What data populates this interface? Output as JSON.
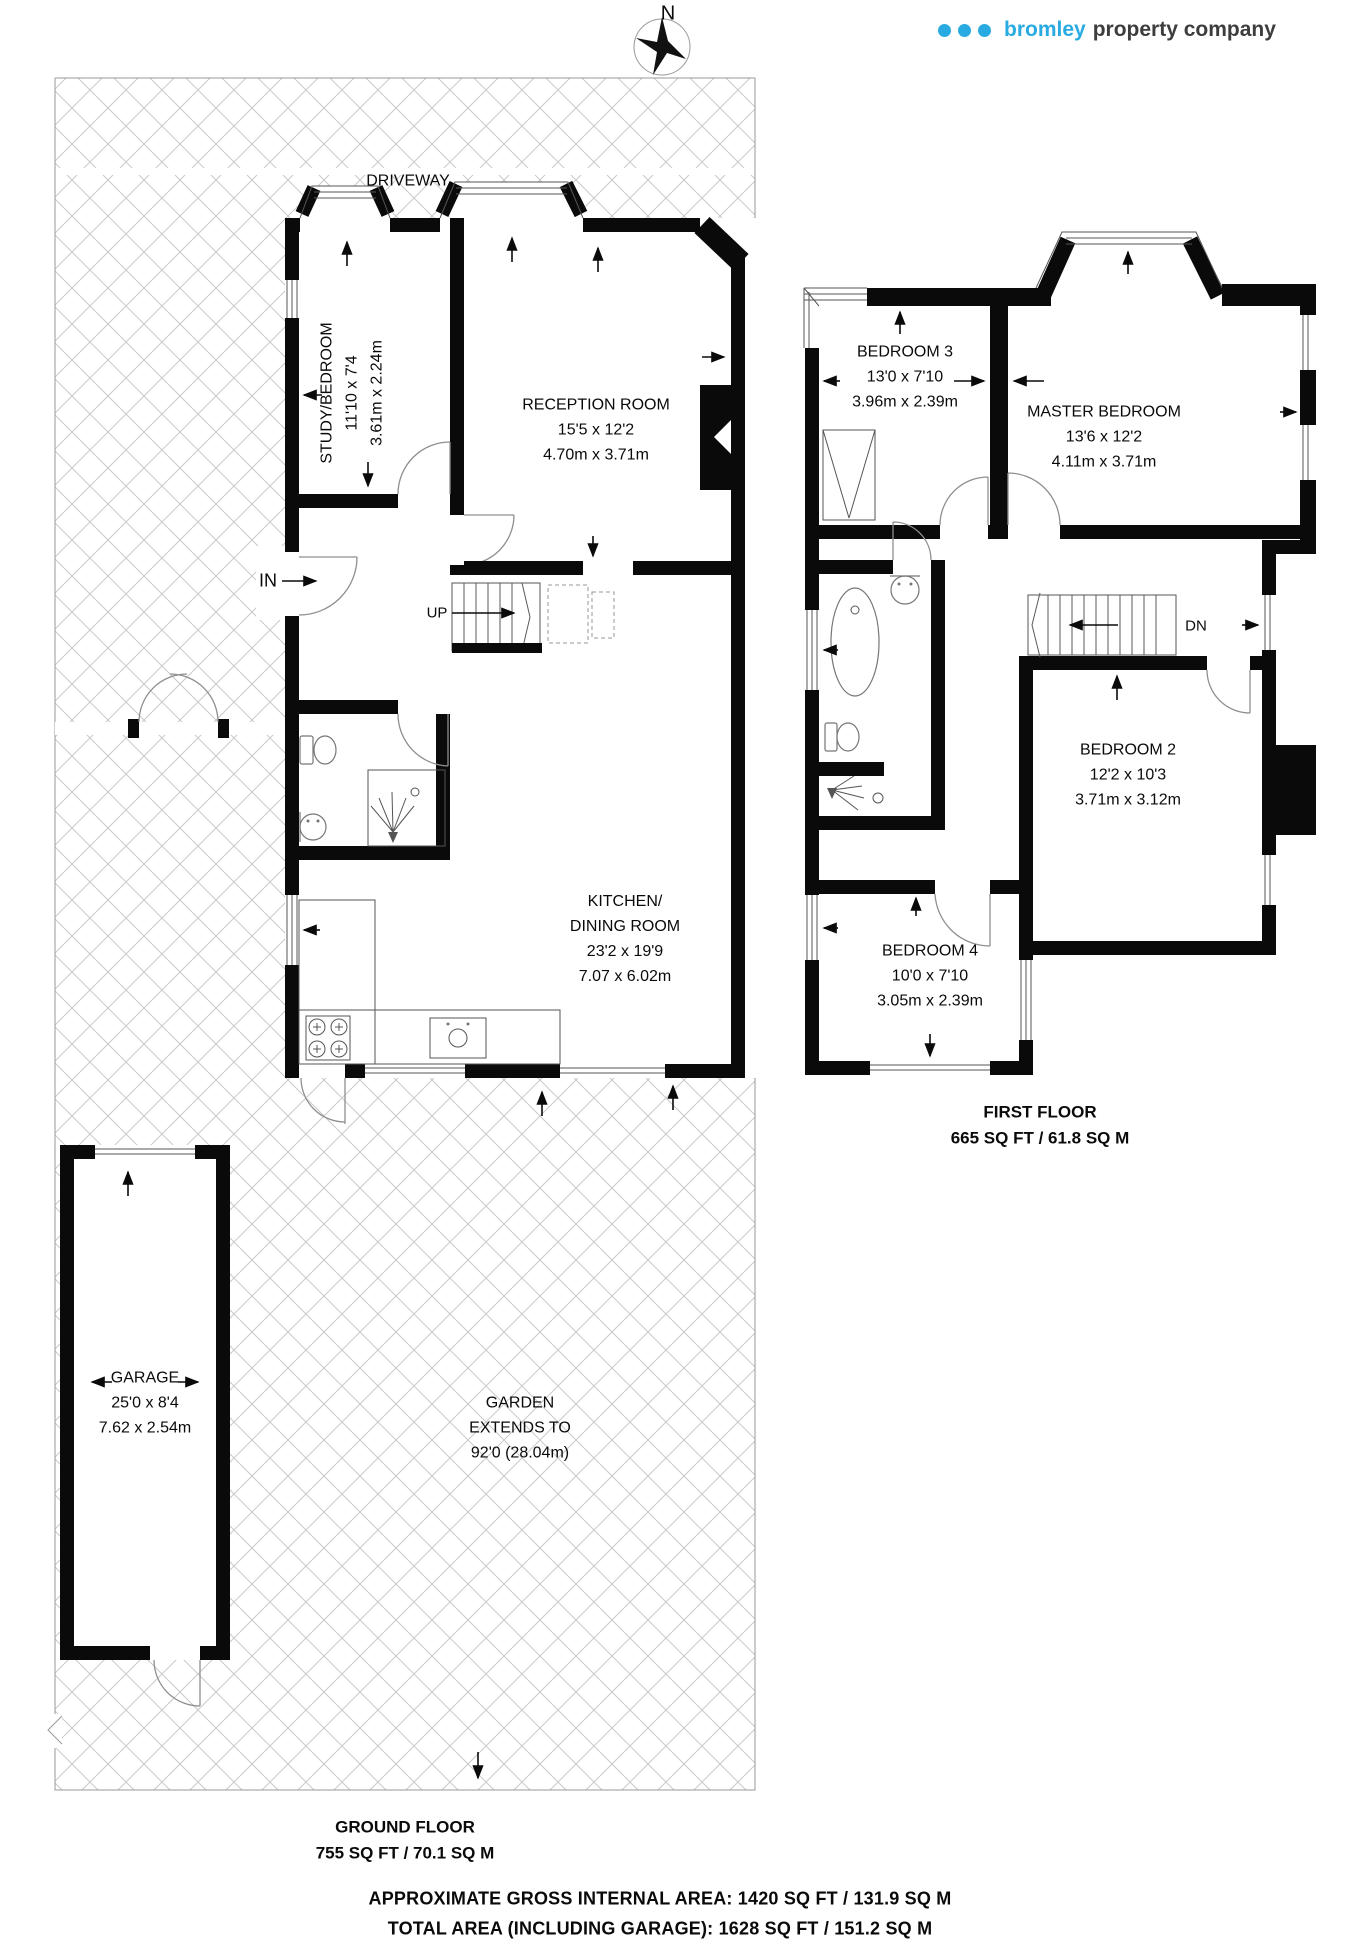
{
  "header": {
    "compass_label": "N",
    "logo": {
      "name": "bromley",
      "suffix": "property company",
      "accent_color": "#29abe2",
      "text_color": "#3d3d3d"
    }
  },
  "outdoor": {
    "driveway_label": "DRIVEWAY",
    "garden_line1": "GARDEN",
    "garden_line2": "EXTENDS TO",
    "garden_line3": "92'0 (28.04m)"
  },
  "ground_floor": {
    "title": "GROUND FLOOR",
    "area": "755 SQ FT / 70.1 SQ M",
    "entrance_label": "IN",
    "stairs_up_label": "UP"
  },
  "first_floor": {
    "title": "FIRST FLOOR",
    "area": "665 SQ FT / 61.8 SQ M",
    "stairs_down_label": "DN"
  },
  "rooms": [
    {
      "id": "study-bedroom",
      "name": "STUDY/BEDROOM",
      "dim_ft": "11'10 x 7'4",
      "dim_m": "3.61m x 2.24m",
      "x": 352,
      "y": 393,
      "rotated": true
    },
    {
      "id": "reception-room",
      "name": "RECEPTION ROOM",
      "dim_ft": "15'5 x 12'2",
      "dim_m": "4.70m x 3.71m",
      "x": 596,
      "y": 430,
      "rotated": false
    },
    {
      "id": "kitchen-dining-room",
      "name": "KITCHEN/",
      "name2": "DINING ROOM",
      "dim_ft": "23'2 x 19'9",
      "dim_m": "7.07 x 6.02m",
      "x": 625,
      "y": 939,
      "rotated": false
    },
    {
      "id": "garage",
      "name": "GARAGE",
      "dim_ft": "25'0 x 8'4",
      "dim_m": "7.62 x 2.54m",
      "x": 145,
      "y": 1403,
      "rotated": false
    },
    {
      "id": "bedroom-3",
      "name": "BEDROOM 3",
      "dim_ft": "13'0 x 7'10",
      "dim_m": "3.96m x 2.39m",
      "x": 905,
      "y": 377,
      "rotated": false
    },
    {
      "id": "master-bedroom",
      "name": "MASTER BEDROOM",
      "dim_ft": "13'6 x 12'2",
      "dim_m": "4.11m x 3.71m",
      "x": 1104,
      "y": 437,
      "rotated": false
    },
    {
      "id": "bedroom-2",
      "name": "BEDROOM 2",
      "dim_ft": "12'2 x 10'3",
      "dim_m": "3.71m x 3.12m",
      "x": 1128,
      "y": 775,
      "rotated": false
    },
    {
      "id": "bedroom-4",
      "name": "BEDROOM 4",
      "dim_ft": "10'0 x 7'10",
      "dim_m": "3.05m x 2.39m",
      "x": 930,
      "y": 976,
      "rotated": false
    }
  ],
  "summary": {
    "line1": "APPROXIMATE GROSS INTERNAL AREA: 1420 SQ FT / 131.9 SQ M",
    "line2": "TOTAL AREA (INCLUDING GARAGE): 1628 SQ FT / 151.2 SQ M"
  }
}
